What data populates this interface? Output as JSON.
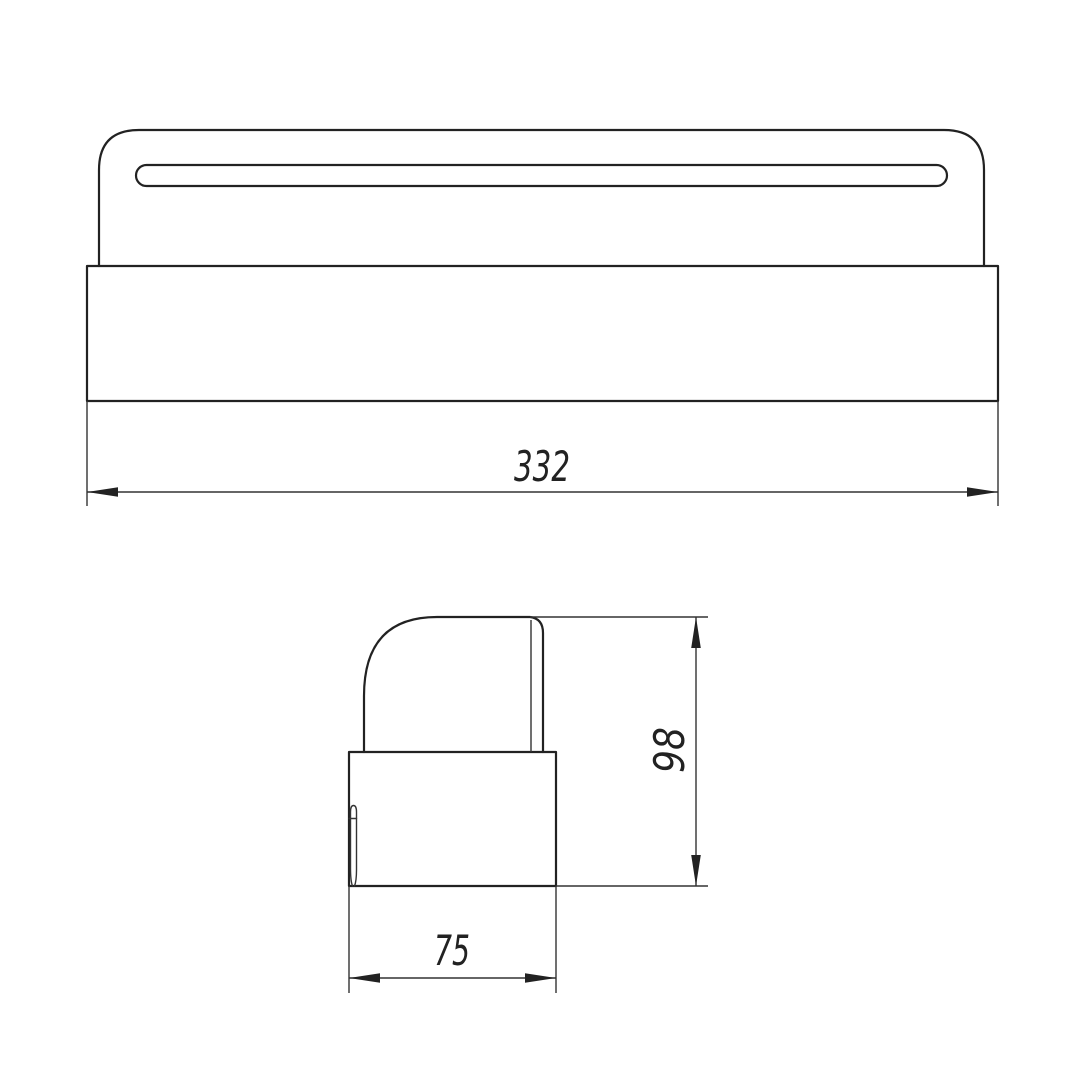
{
  "drawing": {
    "kind": "engineering-dimension-drawing",
    "colors": {
      "background": "#ffffff",
      "line": "#222222",
      "thin_line": "#333333"
    },
    "views": {
      "front": {
        "name": "front view",
        "features": [
          "rounded-top cap",
          "mounting slot",
          "base block"
        ]
      },
      "side": {
        "name": "side profile view",
        "features": [
          "quarter-round cap profile",
          "base block",
          "clip tab detail"
        ]
      }
    },
    "dimensions": {
      "width": {
        "value": "332",
        "orientation": "horizontal",
        "view": "front"
      },
      "height": {
        "value": "98",
        "orientation": "vertical",
        "view": "side"
      },
      "depth": {
        "value": "75",
        "orientation": "horizontal",
        "view": "side"
      }
    }
  }
}
